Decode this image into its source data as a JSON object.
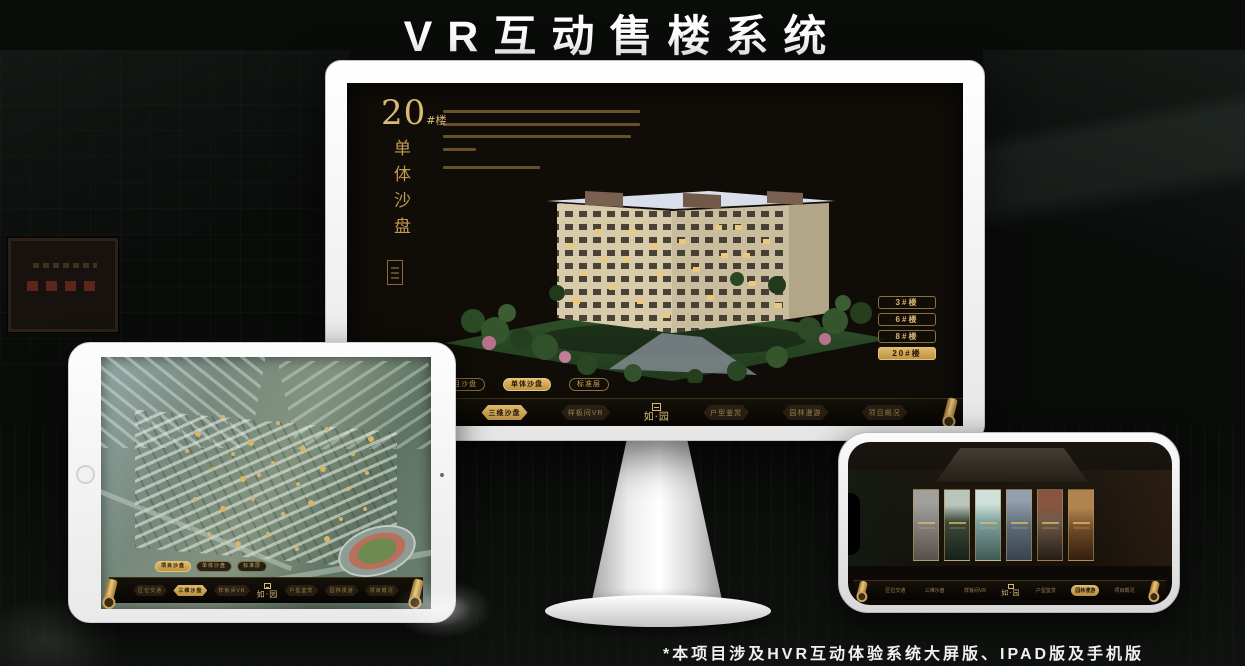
{
  "page": {
    "title": "VR互动售楼系统",
    "footnote": "*本项目涉及HVR互动体验系统大屏版、IPAD版及手机版"
  },
  "colors": {
    "gold": "#c9a255",
    "gold_bright": "#e3bd6e",
    "screen_bg": "#100d08",
    "page_bg": "#0a0c0a"
  },
  "monitor": {
    "heading": {
      "number": "20",
      "suffix": "#楼",
      "vertical_title": "单体沙盘"
    },
    "floor_buttons": [
      {
        "label": "3#楼",
        "active": false
      },
      {
        "label": "6#楼",
        "active": false
      },
      {
        "label": "8#楼",
        "active": false
      },
      {
        "label": "20#楼",
        "active": true
      }
    ],
    "sub_tabs": [
      {
        "label": "项目沙盘",
        "active": false
      },
      {
        "label": "单体沙盘",
        "active": true
      },
      {
        "label": "标准层",
        "active": false
      }
    ],
    "nav": {
      "logo": "如·园",
      "items": [
        {
          "label": "区位交通",
          "active": false
        },
        {
          "label": "三维沙盘",
          "active": true
        },
        {
          "label": "样板间VR",
          "active": false
        },
        {
          "label": "户型鉴赏",
          "active": false
        },
        {
          "label": "园林漫游",
          "active": false
        },
        {
          "label": "项目概况",
          "active": false
        }
      ]
    }
  },
  "tablet": {
    "sub_tabs": [
      {
        "label": "项目沙盘",
        "active": true
      },
      {
        "label": "单体沙盘",
        "active": false
      },
      {
        "label": "标准层",
        "active": false
      }
    ],
    "nav": {
      "logo": "如·园",
      "items": [
        {
          "label": "区位交通",
          "active": false
        },
        {
          "label": "三维沙盘",
          "active": true
        },
        {
          "label": "样板间VR",
          "active": false
        },
        {
          "label": "户型鉴赏",
          "active": false
        },
        {
          "label": "园林漫游",
          "active": false
        },
        {
          "label": "项目概况",
          "active": false
        }
      ]
    }
  },
  "phone": {
    "nav": {
      "logo": "如·园",
      "items": [
        {
          "label": "区位交通",
          "active": false
        },
        {
          "label": "三维沙盘",
          "active": false
        },
        {
          "label": "样板间VR",
          "active": false
        },
        {
          "label": "户型鉴赏",
          "active": false
        },
        {
          "label": "园林漫游",
          "active": true
        },
        {
          "label": "项目概况",
          "active": false
        }
      ]
    }
  }
}
